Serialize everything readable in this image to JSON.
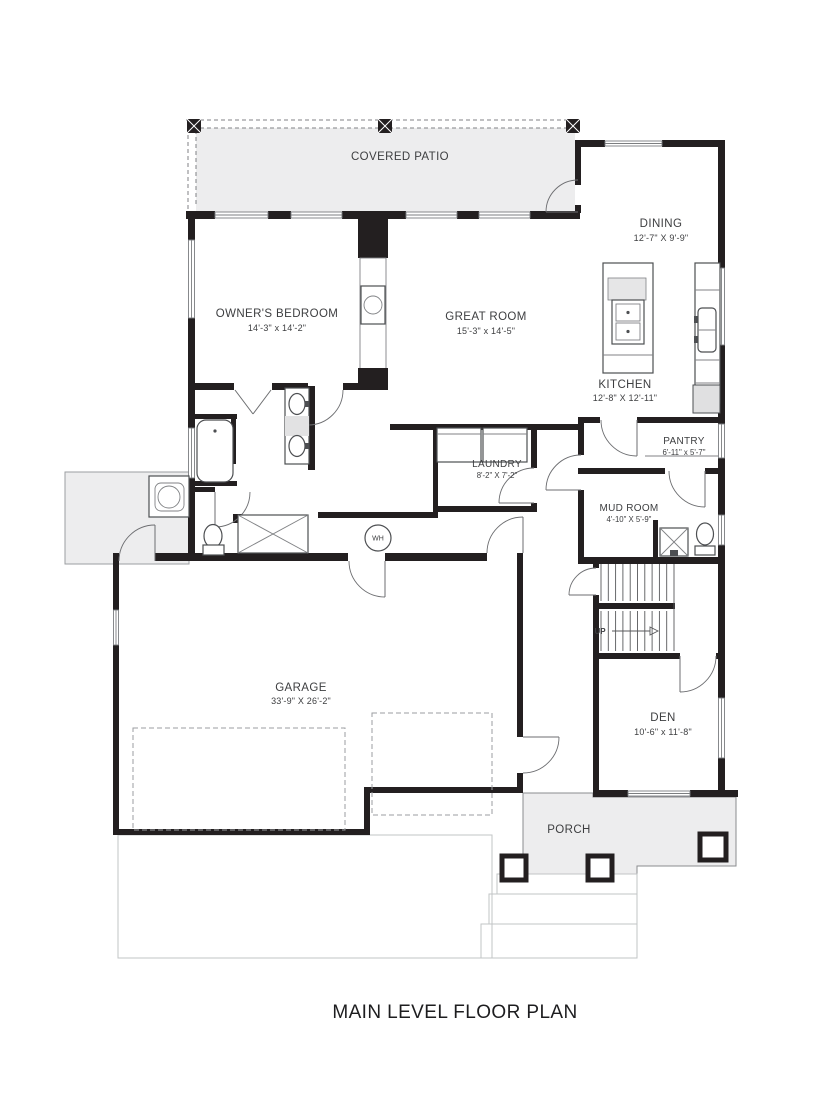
{
  "title": "MAIN LEVEL FLOOR PLAN",
  "rooms": {
    "covered_patio": {
      "name": "COVERED PATIO"
    },
    "dining": {
      "name": "DINING",
      "dims": "12'-7\" X 9'-9\""
    },
    "owners_bedroom": {
      "name": "OWNER'S BEDROOM",
      "dims": "14'-3\" x 14'-2\""
    },
    "great_room": {
      "name": "GREAT ROOM",
      "dims": "15'-3\" x 14'-5\""
    },
    "kitchen": {
      "name": "KITCHEN",
      "dims": "12'-8\" X 12'-11\""
    },
    "pantry": {
      "name": "PANTRY",
      "dims": "6'-11\" x 5'-7\""
    },
    "laundry": {
      "name": "LAUNDRY",
      "dims": "8'-2\" X 7'-2\""
    },
    "mud_room": {
      "name": "MUD ROOM",
      "dims": "4'-10\" X 5'-9\""
    },
    "garage": {
      "name": "GARAGE",
      "dims": "33'-9\" X 26'-2\""
    },
    "den": {
      "name": "DEN",
      "dims": "10'-6\" x 11'-8\""
    },
    "porch": {
      "name": "PORCH"
    }
  },
  "annotations": {
    "stairs_direction": "UP",
    "water_heater": "WH"
  },
  "colors": {
    "wall": "#231f20",
    "shading": "#ededee",
    "thin_line": "#808285",
    "label_text": "#3d3e40",
    "background": "#ffffff"
  }
}
